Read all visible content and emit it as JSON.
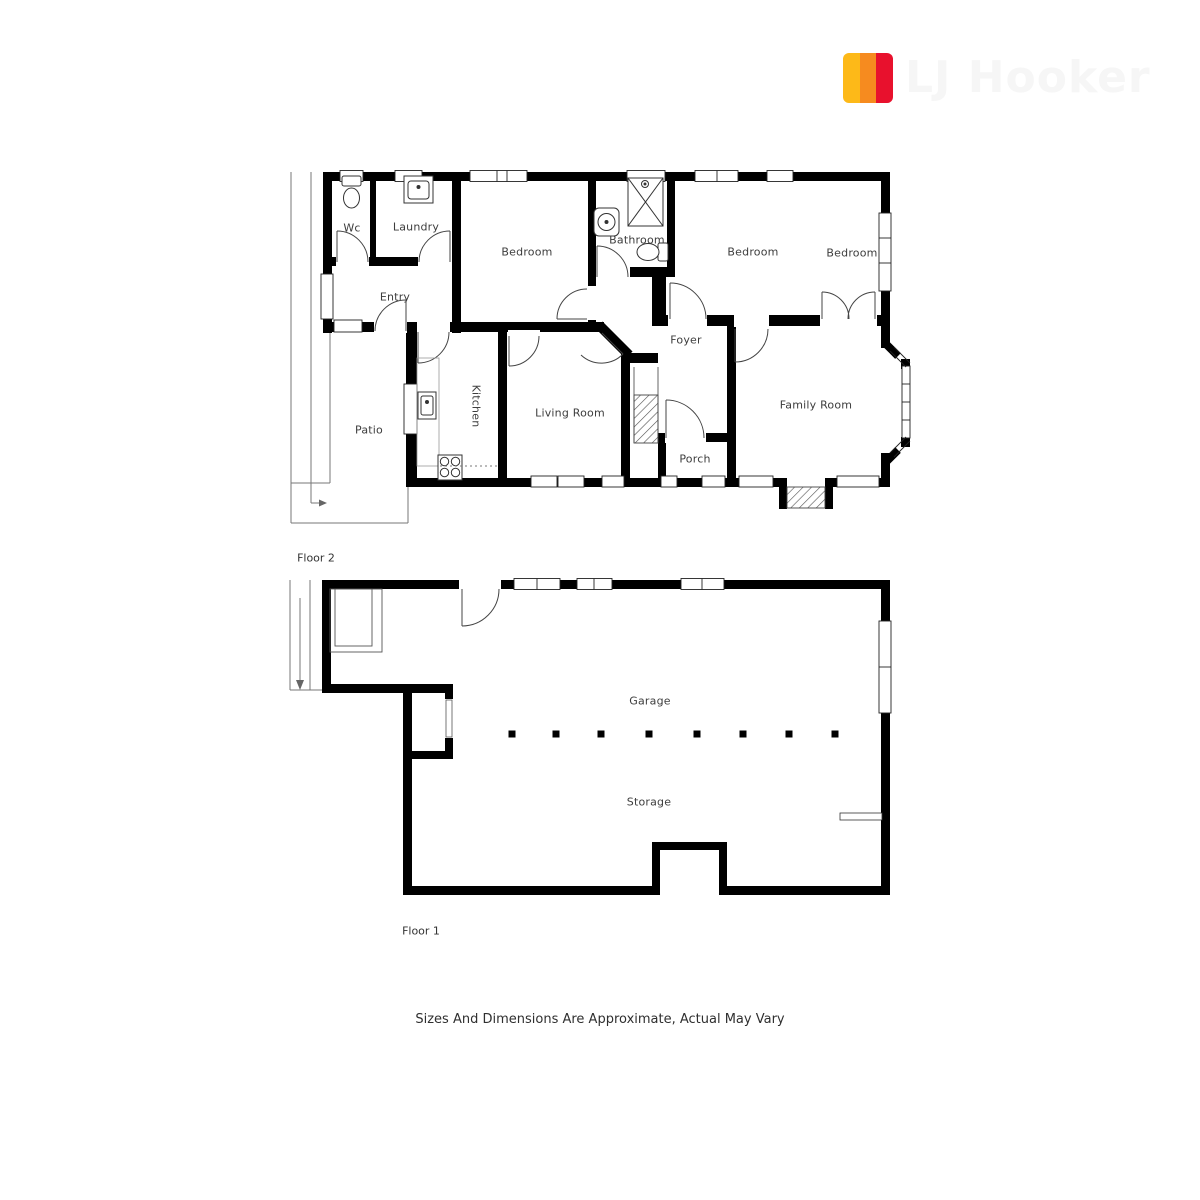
{
  "logo": {
    "brand": "LJ Hooker",
    "wordmark": "LJ Hooker",
    "wordmark_color": "#f6f6f6",
    "stripes": [
      "#FDB918",
      "#F68B1F",
      "#E8112D"
    ]
  },
  "labels": {
    "wc": "Wc",
    "laundry": "Laundry",
    "bedroom1": "Bedroom",
    "bathroom": "Bathroom",
    "bedroom2": "Bedroom",
    "bedroom3": "Bedroom",
    "entry": "Entry",
    "foyer": "Foyer",
    "kitchen": "Kitchen",
    "living": "Living Room",
    "family": "Family Room",
    "patio": "Patio",
    "porch": "Porch",
    "garage": "Garage",
    "storage": "Storage",
    "floor2": "Floor 2",
    "floor1": "Floor 1"
  },
  "disclaimer": "Sizes And Dimensions Are Approximate, Actual May Vary",
  "colors": {
    "wall": "#000000",
    "door": "#444444",
    "outdoor_line": "#666666",
    "label_text": "#3d3d3d"
  }
}
